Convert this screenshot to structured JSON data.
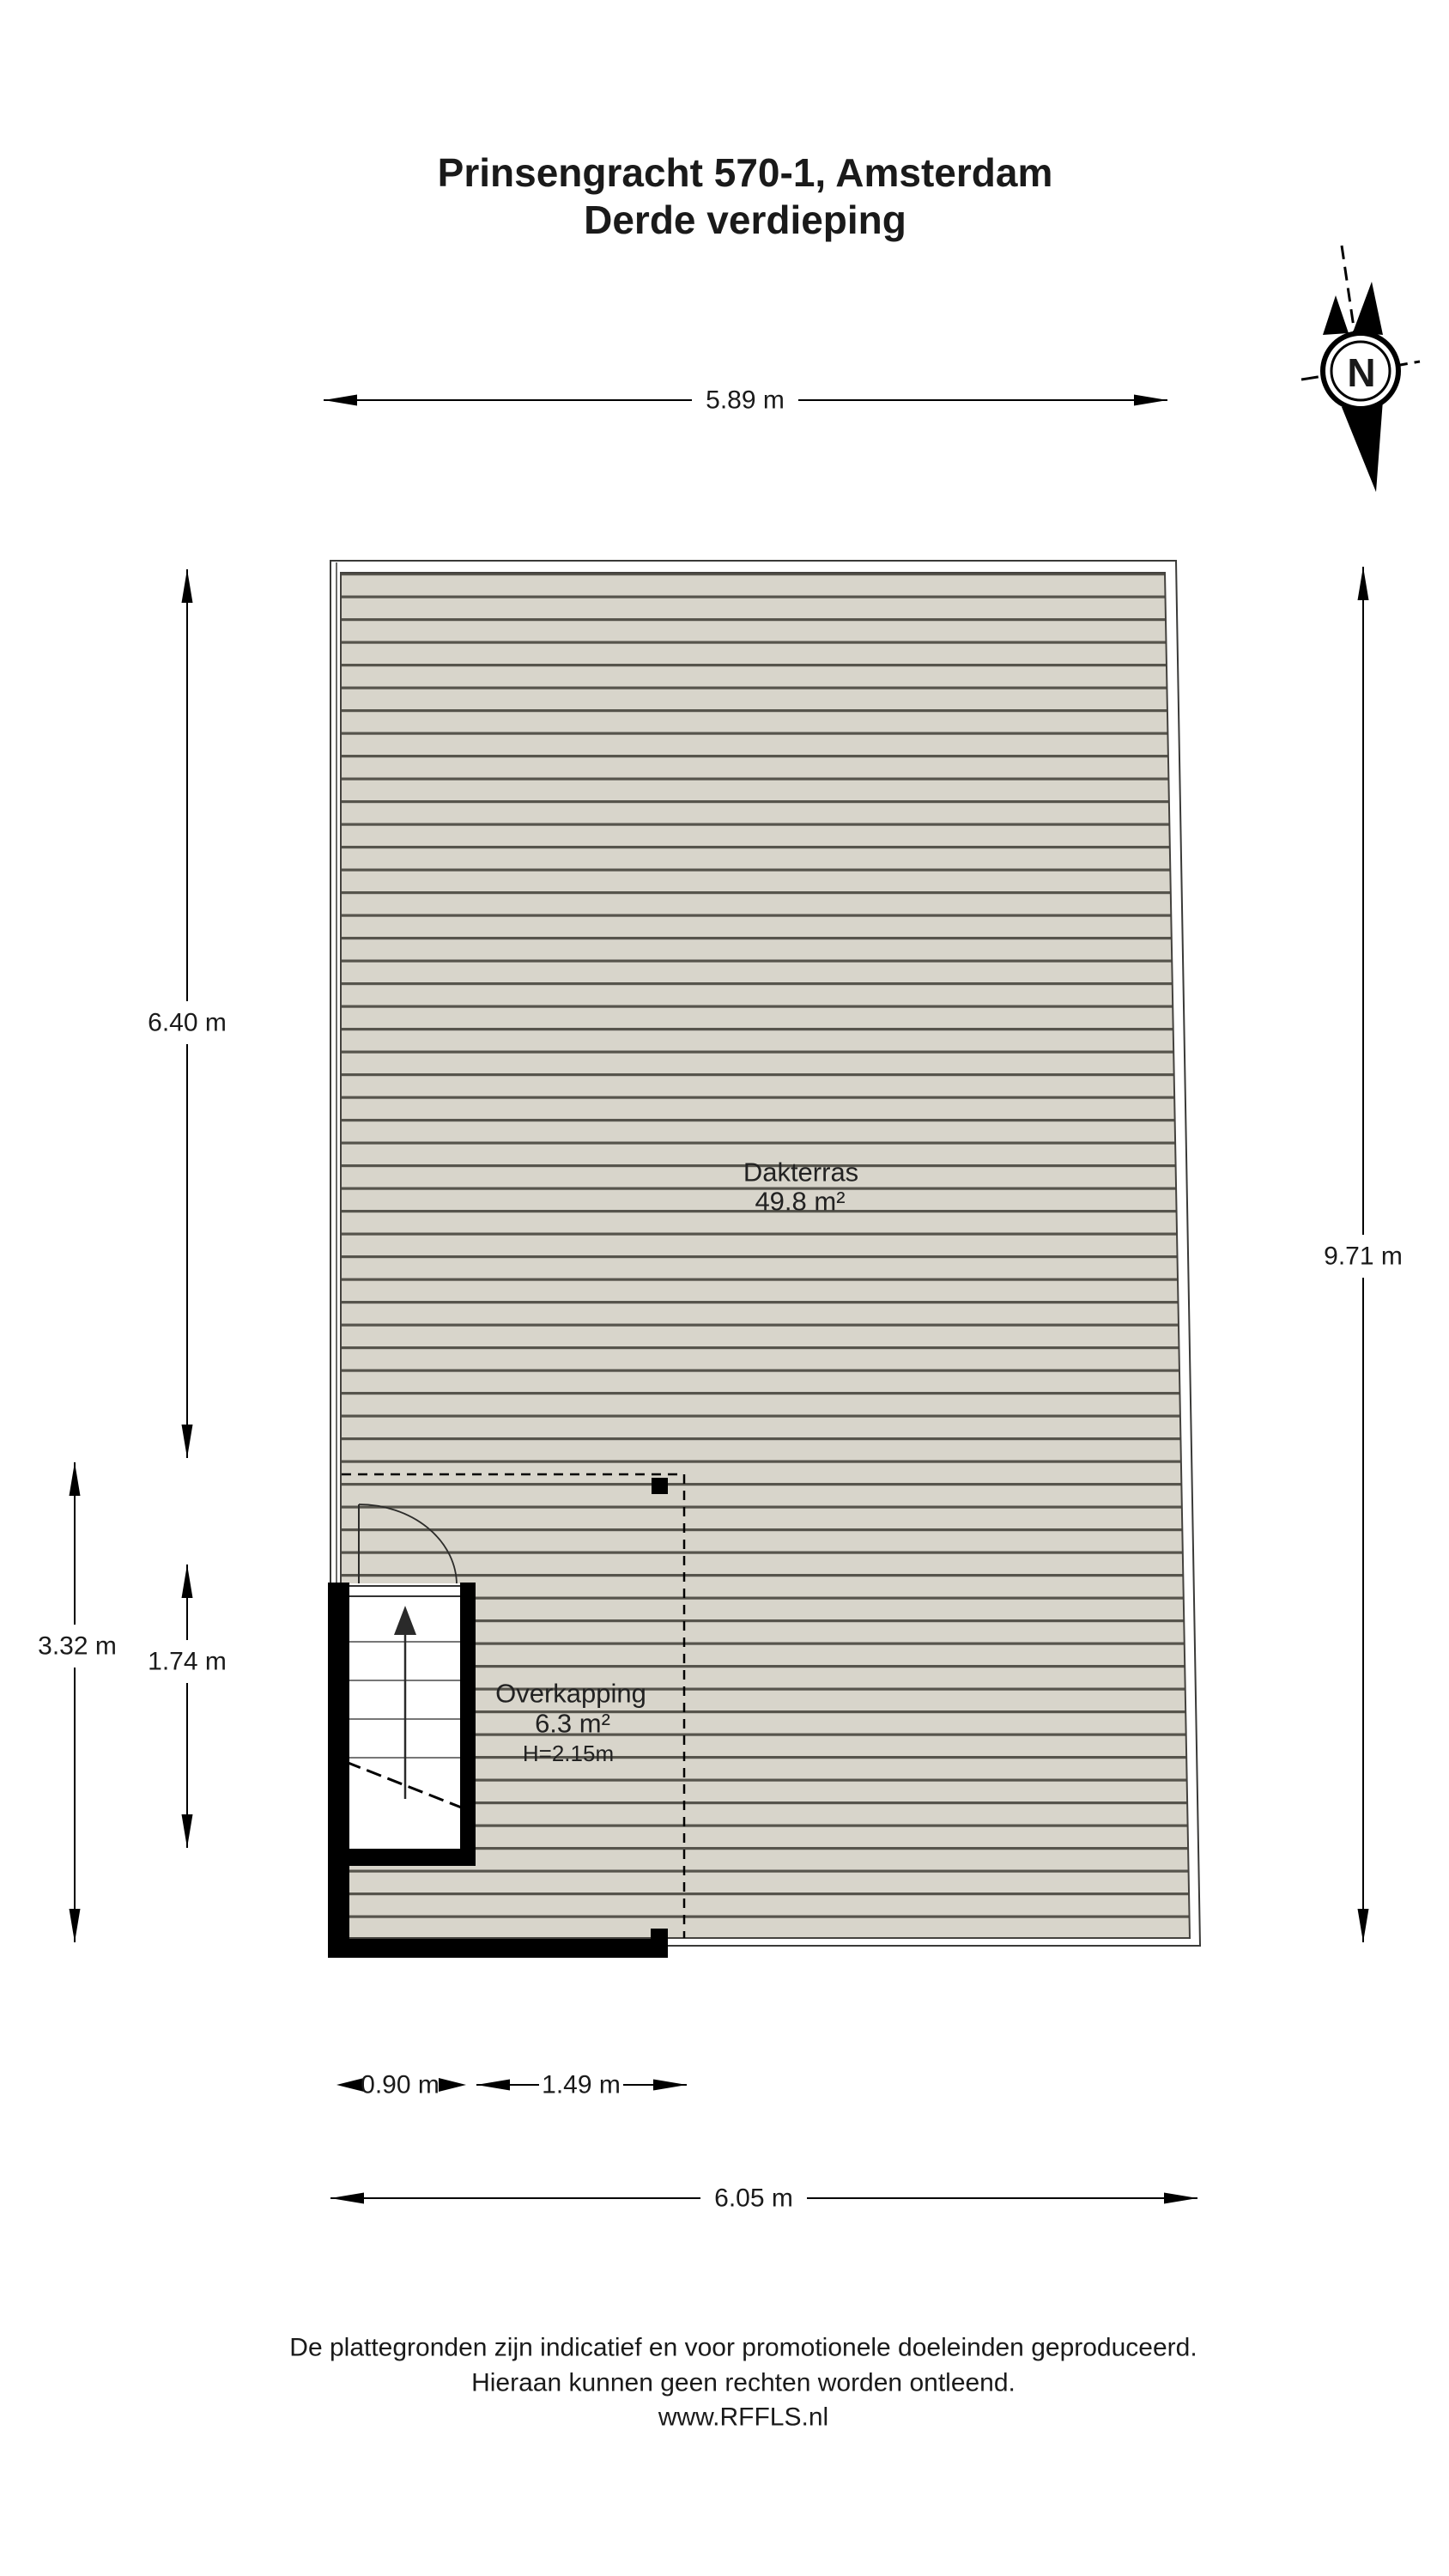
{
  "title": {
    "line1": "Prinsengracht 570-1, Amsterdam",
    "line2": "Derde verdieping"
  },
  "compass": {
    "north_label": "N"
  },
  "rooms": {
    "dakterras": {
      "name": "Dakterras",
      "area": "49.8 m²"
    },
    "overkapping": {
      "name": "Overkapping",
      "area": "6.3 m²",
      "height": "H=2.15m"
    }
  },
  "dimensions": {
    "top": "5.89 m",
    "left_upper": "6.40 m",
    "left_outer": "3.32 m",
    "left_lower": "1.74 m",
    "right": "9.71 m",
    "bottom_stairs": "0.90 m",
    "bottom_inner": "1.49 m",
    "bottom": "6.05 m"
  },
  "footer": {
    "line1": "De plattegronden zijn indicatief en voor promotionele doeleinden geproduceerd.",
    "line2": "Hieraan kunnen geen rechten worden ontleend.",
    "line3": "www.RFFLS.nl"
  },
  "colors": {
    "deck_fill": "#d8d5cb",
    "deck_line": "#56544c",
    "outline": "#3a3a38",
    "wall": "#000000"
  }
}
